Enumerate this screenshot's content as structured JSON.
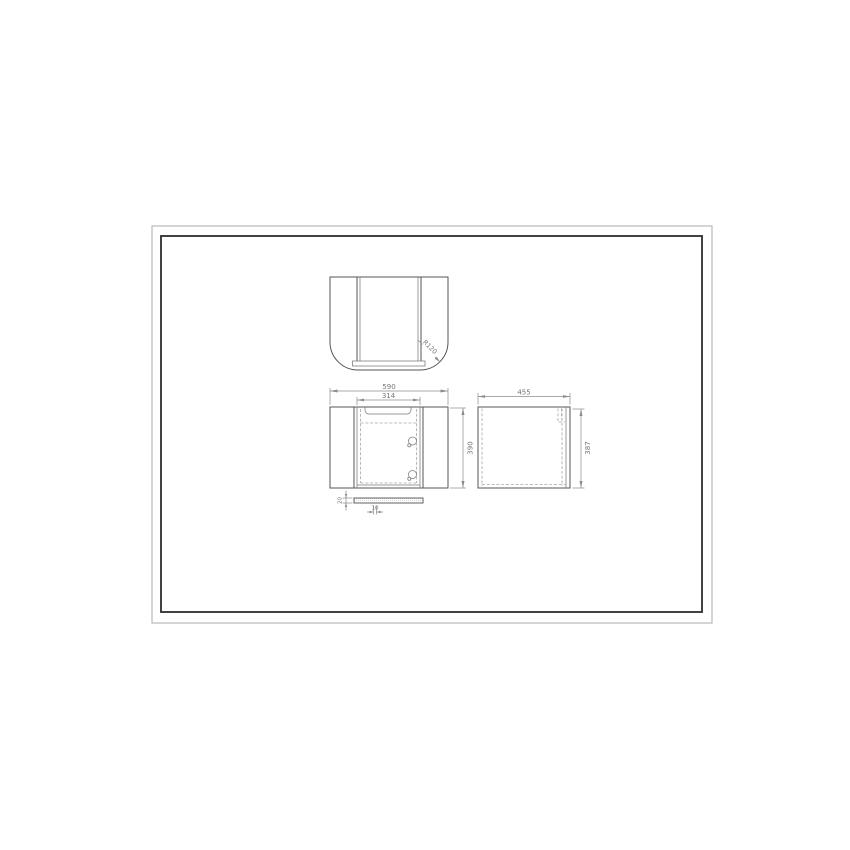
{
  "document": {
    "kind": "cad-furniture-drawing",
    "background_color": "#ffffff",
    "frame_outer_color": "#b8b8b8",
    "frame_inner_color": "#2e2e2e",
    "object_line_color": "#555555",
    "hidden_line_color": "#a6a6a6",
    "dimension_color": "#8c8c8c"
  },
  "dimensions": {
    "top_view": {
      "corner_radius": "R120"
    },
    "front_view": {
      "overall_width": "590",
      "door_width": "314",
      "height": "390"
    },
    "side_view": {
      "depth": "455",
      "height": "387"
    },
    "panel_detail": {
      "thickness": "20",
      "offset": "10"
    }
  }
}
